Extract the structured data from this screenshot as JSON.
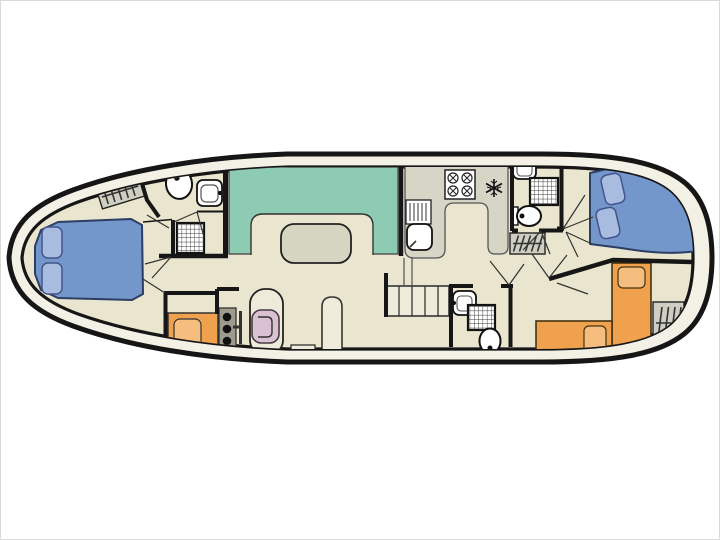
{
  "diagram": {
    "type": "boat-floorplan",
    "description": "Top-down deck plan of a canal houseboat",
    "orientation": "bow-left-stern-right"
  },
  "colors": {
    "background": "#ffffff",
    "hull_outline": "#161616",
    "deck_gap": "#f3f1e5",
    "floor": "#e9e5ce",
    "wall": "#161616",
    "thin_line": "#333333",
    "dinette_bench": "#8dccb3",
    "table": "#d5d5c2",
    "counter": "#d6d5c6",
    "fixture_white": "#ffffff",
    "double_bed_blue": "#7396cb",
    "pillow_blue": "#a8bce0",
    "bed_outline_blue": "#2c3e63",
    "single_bed_orange": "#f0a14d",
    "pillow_orange": "#f5be7f",
    "bed_outline_orange": "#4a3a20",
    "hatch_gray": "#cfcec2",
    "console_gray": "#9c9b8e",
    "helm_chair_pink": "#d9c2d2",
    "step_fill": "#efebda",
    "inner_fixture_line": "#555555"
  },
  "components": {
    "bow_cabin": [
      "double-bed",
      "pillow",
      "pillow"
    ],
    "bow_bathroom": [
      "toilet",
      "washbasin",
      "shower"
    ],
    "deck_access": [
      "bow-hatch-steps",
      "mid-hatch-steps",
      "stern-hatch-steps"
    ],
    "dinette": [
      "u-shaped-bench",
      "table"
    ],
    "galley": [
      "u-shaped-counter",
      "stove-4-burner",
      "sink-with-drainer",
      "fridge-freezer"
    ],
    "helm_station": [
      "console",
      "control-knobs",
      "steering-wheel",
      "helm-seat",
      "locker"
    ],
    "mid_bathroom": [
      "washbasin",
      "shower",
      "toilet"
    ],
    "aft_bathroom": [
      "washbasin",
      "shower",
      "toilet"
    ],
    "aft_double_cabin": [
      "double-bed",
      "pillow",
      "pillow"
    ],
    "aft_twin_cabin": [
      "single-bed",
      "single-bed",
      "pillow",
      "pillow"
    ],
    "companionway": [
      "steps"
    ]
  }
}
